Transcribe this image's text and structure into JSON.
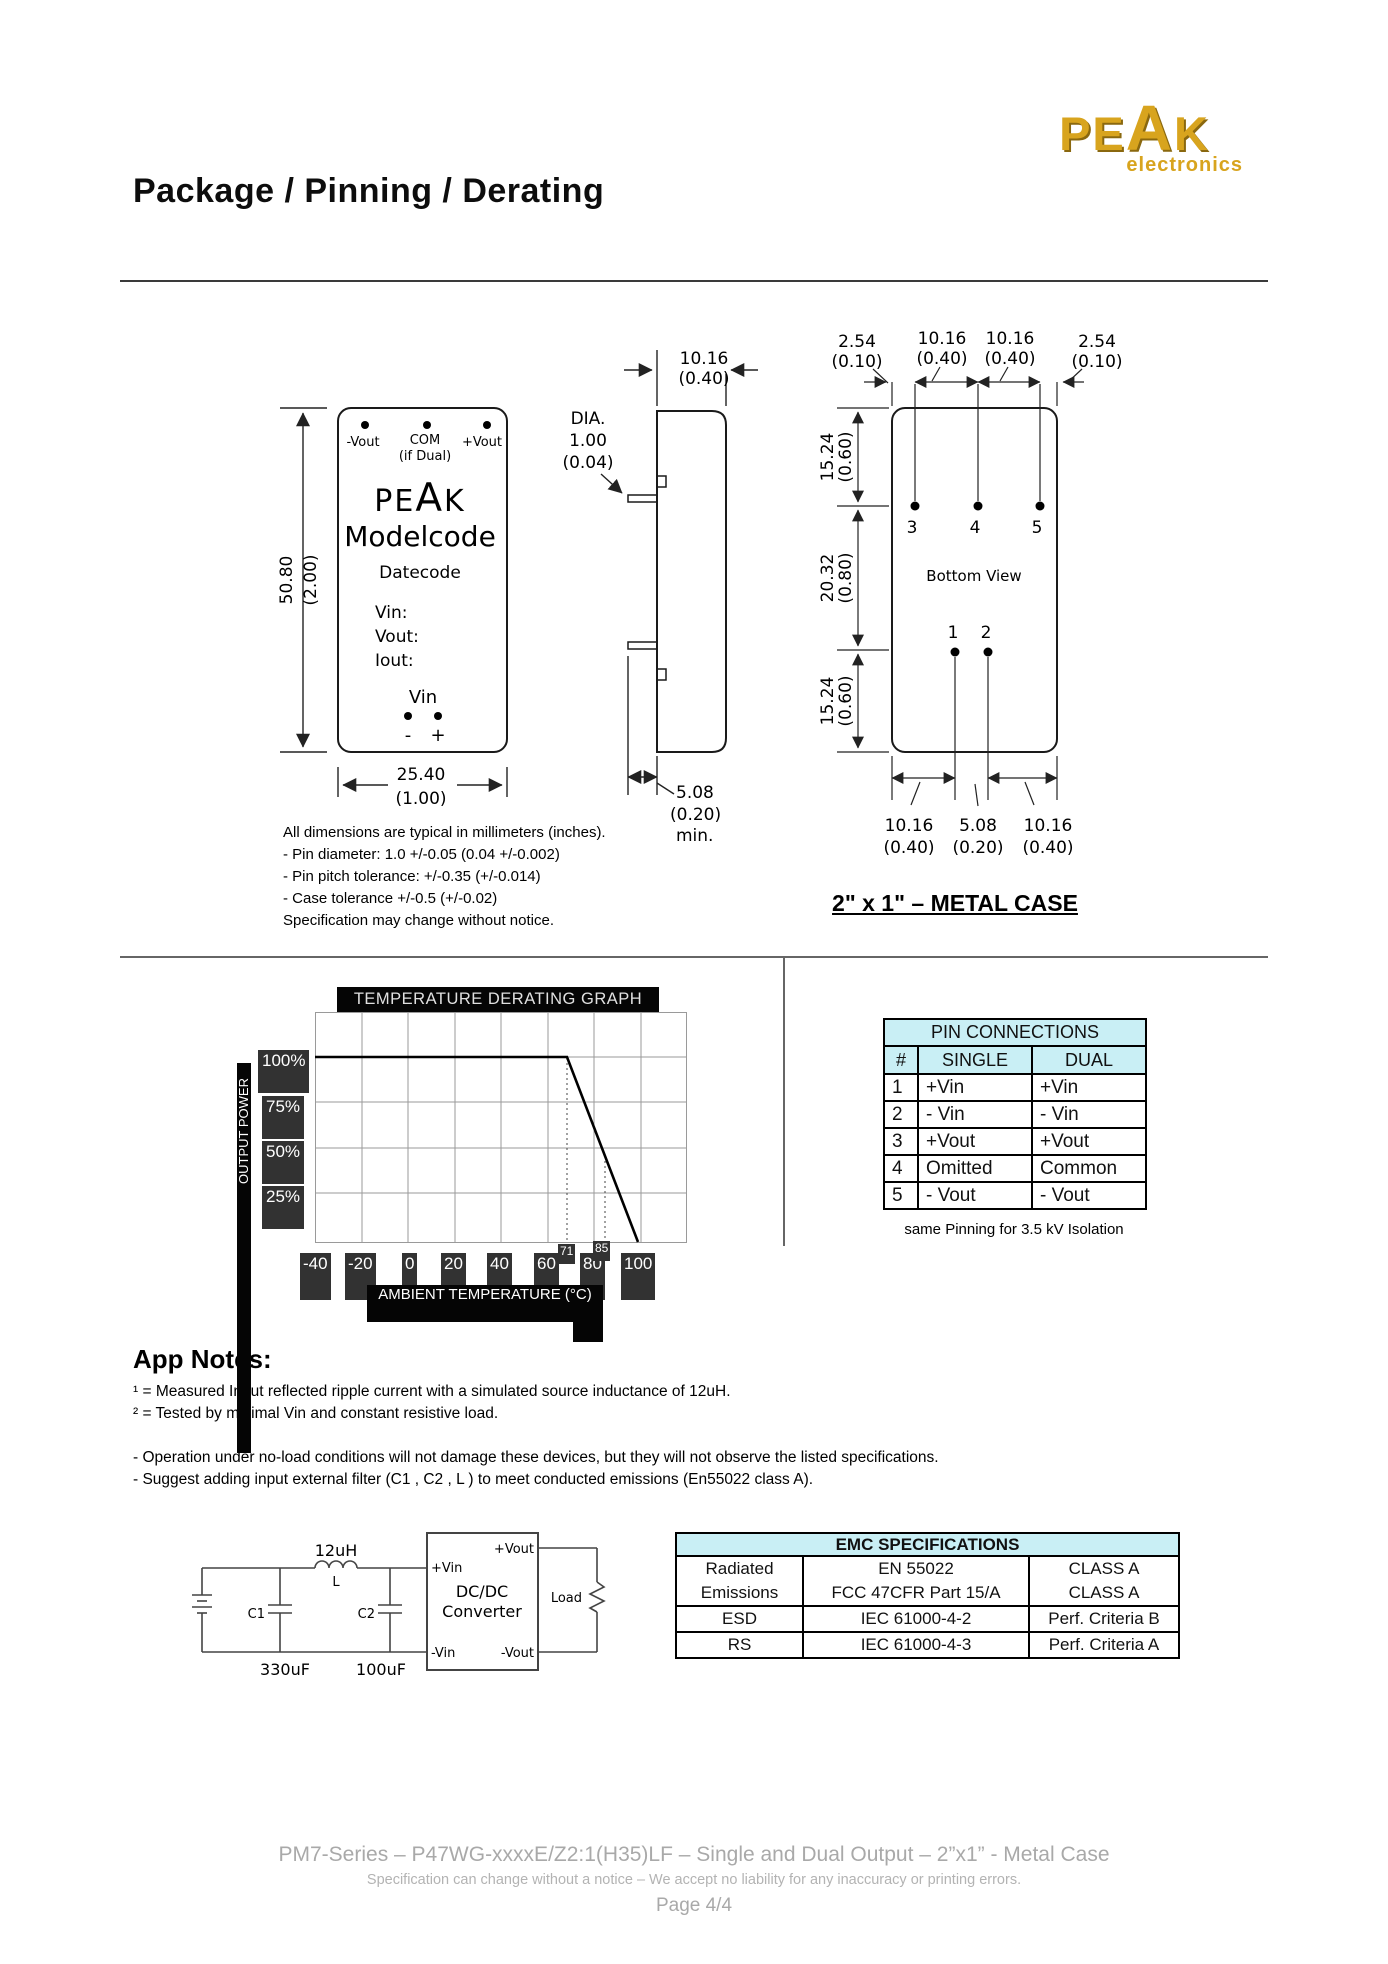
{
  "header": {
    "title": "Package / Pinning / Derating",
    "logo_pe": "PE",
    "logo_a": "A",
    "logo_k": "K",
    "logo_sub": "electronics"
  },
  "front_view": {
    "pin1": "-Vout",
    "pin2": "COM",
    "pin2b": "(if Dual)",
    "pin3": "+Vout",
    "brand_pe": "PE",
    "brand_a": "A",
    "brand_k": "K",
    "model": "Modelcode",
    "date": "Datecode",
    "f1": "Vin:",
    "f2": "Vout:",
    "f3": "Iout:",
    "vin": "Vin",
    "minus": "-",
    "plus": "+",
    "h_mm": "50.80",
    "h_in": "(2.00)",
    "w_mm": "25.40",
    "w_in": "(1.00)"
  },
  "side_view": {
    "d_mm": "10.16",
    "d_in": "(0.40)",
    "dia1": "DIA.",
    "dia2": "1.00",
    "dia3": "(0.04)",
    "p_mm": "5.08",
    "p_in": "(0.20)",
    "p_min": "min."
  },
  "bottom_view": {
    "t1mm": "2.54",
    "t1in": "(0.10)",
    "t2mm": "10.16",
    "t2in": "(0.40)",
    "t3mm": "10.16",
    "t3in": "(0.40)",
    "t4mm": "2.54",
    "t4in": "(0.10)",
    "l1mm": "15.24",
    "l1in": "(0.60)",
    "l2mm": "20.32",
    "l2in": "(0.80)",
    "l3mm": "15.24",
    "l3in": "(0.60)",
    "b1mm": "10.16",
    "b1in": "(0.40)",
    "b2mm": "5.08",
    "b2in": "(0.20)",
    "b3mm": "10.16",
    "b3in": "(0.40)",
    "pin3": "3",
    "pin4": "4",
    "pin5": "5",
    "pin1": "1",
    "pin2": "2",
    "label": "Bottom View"
  },
  "dimension_notes": [
    "All dimensions are typical in millimeters (inches).",
    "- Pin diameter: 1.0 +/-0.05 (0.04 +/-0.002)",
    "- Pin pitch tolerance: +/-0.35 (+/-0.014)",
    "- Case tolerance +/-0.5 (+/-0.02)",
    "Specification may change without notice."
  ],
  "case_heading": "2\" x 1\"  – METAL CASE",
  "chart_data": {
    "type": "line",
    "title": "TEMPERATURE DERATING GRAPH",
    "xlabel": "AMBIENT TEMPERATURE (°C)",
    "ylabel": "OUTPUT POWER",
    "x_ticks": [
      -40,
      -20,
      0,
      20,
      40,
      60,
      80,
      100
    ],
    "y_ticks": [
      "100%",
      "75%",
      "50%",
      "25%"
    ],
    "xlim": [
      -40,
      120
    ],
    "ylim": [
      0,
      125
    ],
    "grid": true,
    "series": [
      {
        "name": "derating-curve",
        "points": [
          [
            -40,
            100
          ],
          [
            71,
            100
          ],
          [
            100,
            0
          ]
        ]
      }
    ],
    "annotations": [
      {
        "x": 71,
        "label": "71"
      },
      {
        "x": 85,
        "label": "85"
      }
    ]
  },
  "graph": {
    "title": "TEMPERATURE DERATING GRAPH",
    "ylabel": "OUTPUT POWER",
    "xlabel": "AMBIENT TEMPERATURE (°C)",
    "yticks": [
      "100%",
      "75%",
      "50%",
      "25%"
    ],
    "xticks": [
      "-40",
      "-20",
      "0",
      "20",
      "40",
      "60",
      "80",
      "100"
    ],
    "ann71": "71",
    "ann85": "85"
  },
  "pin_table": {
    "title": "PIN CONNECTIONS",
    "col_num": "#",
    "col_single": "SINGLE",
    "col_dual": "DUAL",
    "rows": [
      [
        "1",
        "+Vin",
        "+Vin"
      ],
      [
        "2",
        "- Vin",
        "- Vin"
      ],
      [
        "3",
        "+Vout",
        "+Vout"
      ],
      [
        "4",
        "Omitted",
        "Common"
      ],
      [
        "5",
        "- Vout",
        "- Vout"
      ]
    ],
    "caption": "same Pinning for 3.5 kV Isolation"
  },
  "app_notes": {
    "heading": "App Notes:",
    "lines": [
      "¹ = Measured Input reflected ripple current with a simulated source inductance of 12uH.",
      "² = Tested by minimal Vin and constant resistive load.",
      "",
      "- Operation under no-load conditions will not damage these devices, but they will not observe the listed specifications.",
      "- Suggest adding input external filter (C1 , C2 , L ) to meet conducted emissions (En55022 class A)."
    ]
  },
  "circuit": {
    "l_value": "12uH",
    "l_name": "L",
    "c1": "C1",
    "c2": "C2",
    "c1_value": "330uF",
    "c2_value": "100uF",
    "vin_p": "+Vin",
    "vin_n": "-Vin",
    "vout_p": "+Vout",
    "vout_n": "-Vout",
    "box1": "DC/DC",
    "box2": "Converter",
    "load": "Load"
  },
  "emc_table": {
    "title": "EMC SPECIFICATIONS",
    "rows": [
      {
        "c1": [
          "Radiated",
          "Emissions"
        ],
        "c2": [
          "EN 55022",
          "FCC 47CFR Part 15/A"
        ],
        "c3": [
          "CLASS A",
          "CLASS A"
        ]
      },
      {
        "c1": [
          "ESD"
        ],
        "c2": [
          "IEC 61000-4-2"
        ],
        "c3": [
          "Perf. Criteria B"
        ]
      },
      {
        "c1": [
          "RS"
        ],
        "c2": [
          "IEC 61000-4-3"
        ],
        "c3": [
          "Perf. Criteria A"
        ]
      }
    ]
  },
  "footer": {
    "line1": "PM7-Series – P47WG-xxxxE/Z2:1(H35)LF – Single and Dual Output – 2”x1” - Metal Case",
    "line2": "Specification can change without a notice – We accept no liability for any inaccuracy or printing errors.",
    "line3": "Page 4/4"
  }
}
